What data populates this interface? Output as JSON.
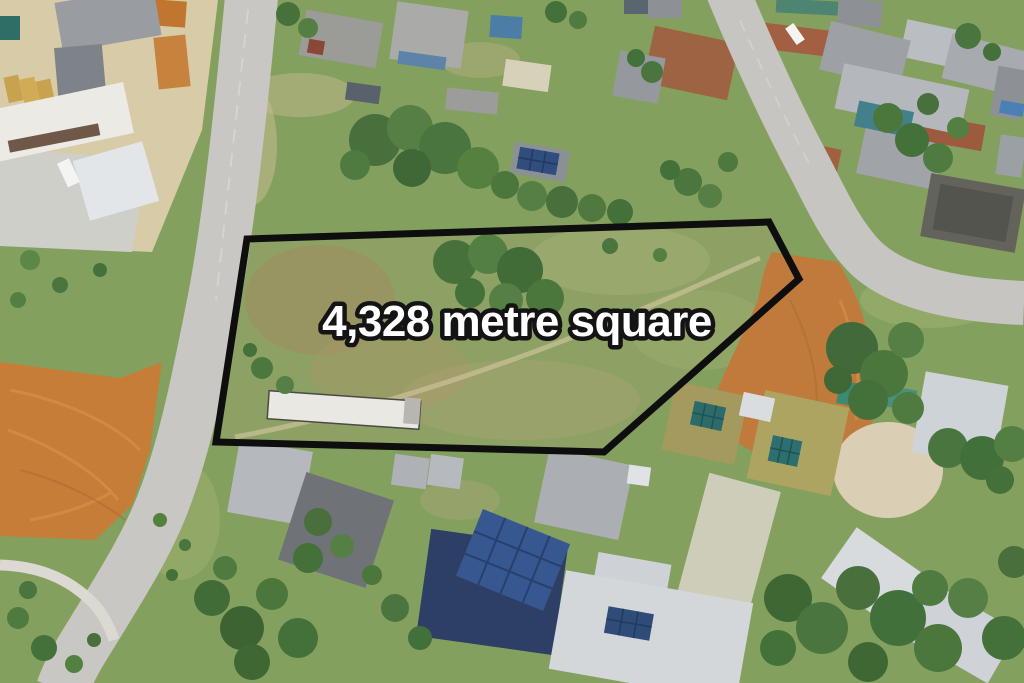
{
  "image": {
    "kind": "aerial-drone-photo",
    "subject": "Vacant residential land parcel outlined in black with area annotation",
    "annotation": {
      "area_label": "4,328 metre square",
      "label_color": "#ffffff",
      "label_outline_color": "#141414",
      "boundary_color": "#0e0e0e",
      "boundary_points": "247,239 769,222 799,279 604,452 216,442"
    },
    "palette": {
      "grass_green": "#84a05e",
      "parcel_green": "#8ca163",
      "dirt_orange": "#c67d38",
      "road_gray": "#c8c7c3",
      "tree_green": "#4a753e",
      "roof_gray": "#a7abaf",
      "roof_olive": "#a49a5d",
      "roof_navy": "#2d3f64",
      "solar_panel_blue": "#36578f",
      "roof_white": "#d4d7da"
    }
  }
}
